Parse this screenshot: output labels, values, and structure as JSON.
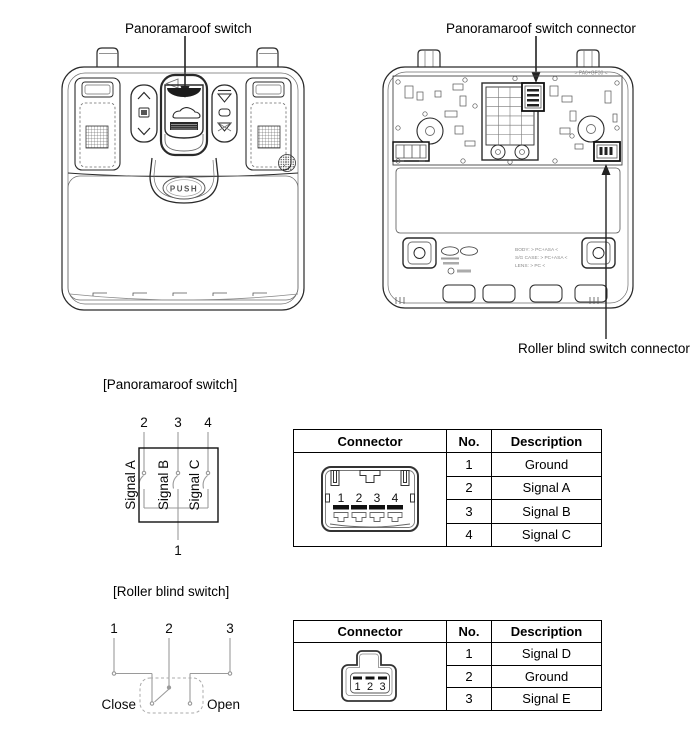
{
  "page": {
    "background": "#ffffff",
    "ink_color": "#1a1a1a",
    "schematic_line_color": "#9a9a9a"
  },
  "callouts": {
    "panoramaroof_switch": "Panoramaroof switch",
    "panoramaroof_switch_connector": "Panoramaroof switch connector",
    "roller_blind_switch_connector": "Roller blind switch connector"
  },
  "sections": {
    "panoramaroof_switch": "[Panoramaroof switch]",
    "roller_blind_switch": "[Roller blind switch]"
  },
  "console_front": {
    "push_label": "PUSH"
  },
  "console_back": {
    "material_marking_top": "> PA6+GF30 <",
    "markings": [
      "BODY: > PC+ASA <",
      "S/G CASE: > PC+ASA <",
      "LENS: > PC <"
    ]
  },
  "panoramaroof_schematic": {
    "top_pins": [
      "2",
      "3",
      "4"
    ],
    "bottom_pin": "1",
    "signals": [
      "Signal A",
      "Signal B",
      "Signal C"
    ]
  },
  "roller_blind_schematic": {
    "top_pins": [
      "1",
      "2",
      "3"
    ],
    "close_label": "Close",
    "open_label": "Open"
  },
  "panoramaroof_connector_table": {
    "headers": {
      "connector": "Connector",
      "no": "No.",
      "description": "Description"
    },
    "connector_pins": [
      "1",
      "2",
      "3",
      "4"
    ],
    "rows": [
      {
        "no": "1",
        "description": "Ground"
      },
      {
        "no": "2",
        "description": "Signal A"
      },
      {
        "no": "3",
        "description": "Signal B"
      },
      {
        "no": "4",
        "description": "Signal C"
      }
    ]
  },
  "roller_blind_connector_table": {
    "headers": {
      "connector": "Connector",
      "no": "No.",
      "description": "Description"
    },
    "connector_pins": [
      "1",
      "2",
      "3"
    ],
    "rows": [
      {
        "no": "1",
        "description": "Signal D"
      },
      {
        "no": "2",
        "description": "Ground"
      },
      {
        "no": "3",
        "description": "Signal E"
      }
    ]
  }
}
